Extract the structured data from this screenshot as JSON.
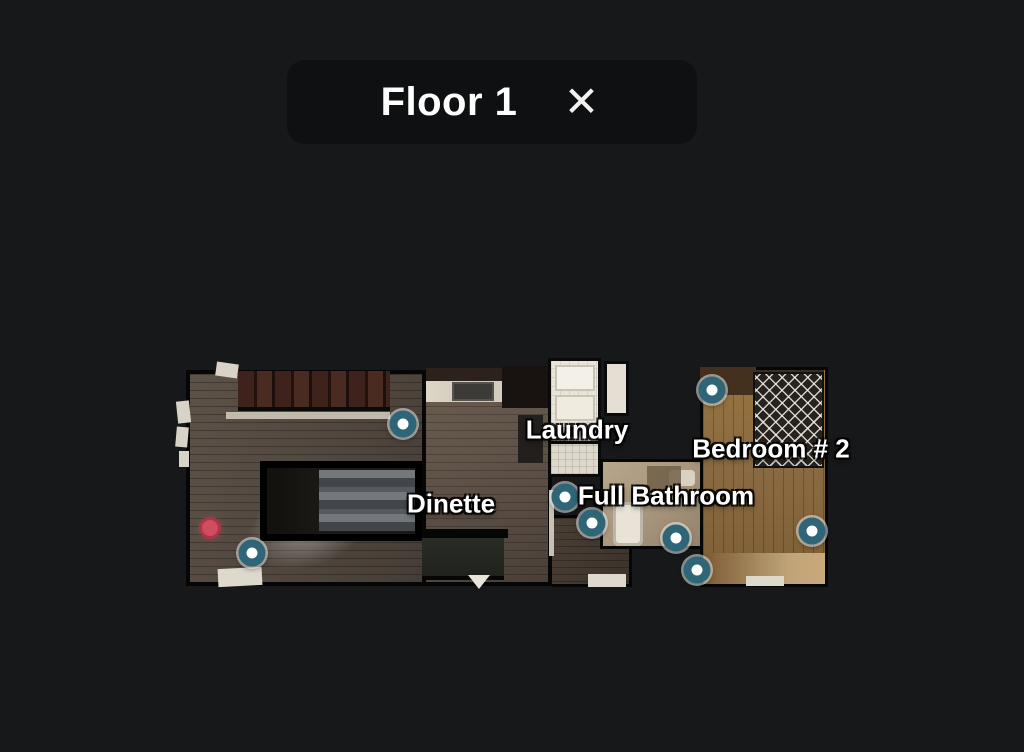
{
  "header": {
    "title": "Floor 1",
    "close_icon": "✕"
  },
  "colors": {
    "background": "#17181a",
    "panel": "#0f1012",
    "title_text": "#ffffff",
    "marker_ring": "#2e6678",
    "marker_center": "#ffffff",
    "position_color": "#d94f63",
    "label_color": "#ffffff"
  },
  "floorplan": {
    "labels": [
      {
        "id": "laundry",
        "text": "Laundry",
        "x": 577,
        "y": 430
      },
      {
        "id": "bedroom-2",
        "text": "Bedroom # 2",
        "x": 771,
        "y": 449
      },
      {
        "id": "full-bathroom",
        "text": "Full Bathroom",
        "x": 666,
        "y": 496
      },
      {
        "id": "dinette",
        "text": "Dinette",
        "x": 451,
        "y": 504
      }
    ],
    "markers": [
      {
        "id": "1",
        "x": 403,
        "y": 424
      },
      {
        "id": "2",
        "x": 252,
        "y": 553
      },
      {
        "id": "3",
        "x": 712,
        "y": 390
      },
      {
        "id": "4",
        "x": 565,
        "y": 497
      },
      {
        "id": "5",
        "x": 592,
        "y": 523
      },
      {
        "id": "6",
        "x": 676,
        "y": 538
      },
      {
        "id": "7",
        "x": 697,
        "y": 570
      },
      {
        "id": "8",
        "x": 812,
        "y": 531
      }
    ],
    "current_position": {
      "x": 210,
      "y": 528
    }
  }
}
